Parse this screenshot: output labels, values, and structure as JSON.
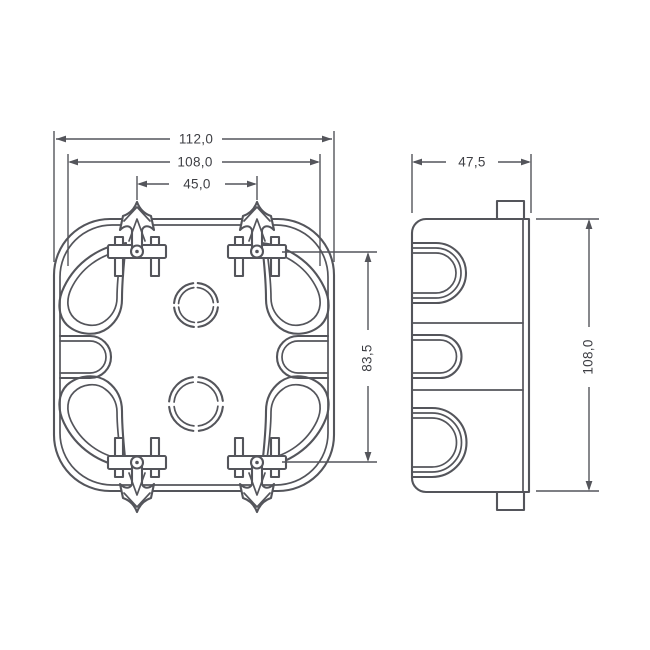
{
  "colors": {
    "line": "#54555b",
    "text": "#3e3f44",
    "bg": "#ffffff"
  },
  "drawing": {
    "type": "technical-drawing",
    "subject": "flush-mount junction box, front view and side view",
    "front_view": {
      "dim_outer_width": "112,0",
      "dim_flange_width": "108,0",
      "dim_clip_spacing": "45,0",
      "dim_screw_spacing": "83,5"
    },
    "side_view": {
      "dim_depth": "47,5",
      "dim_height": "108,0"
    }
  }
}
